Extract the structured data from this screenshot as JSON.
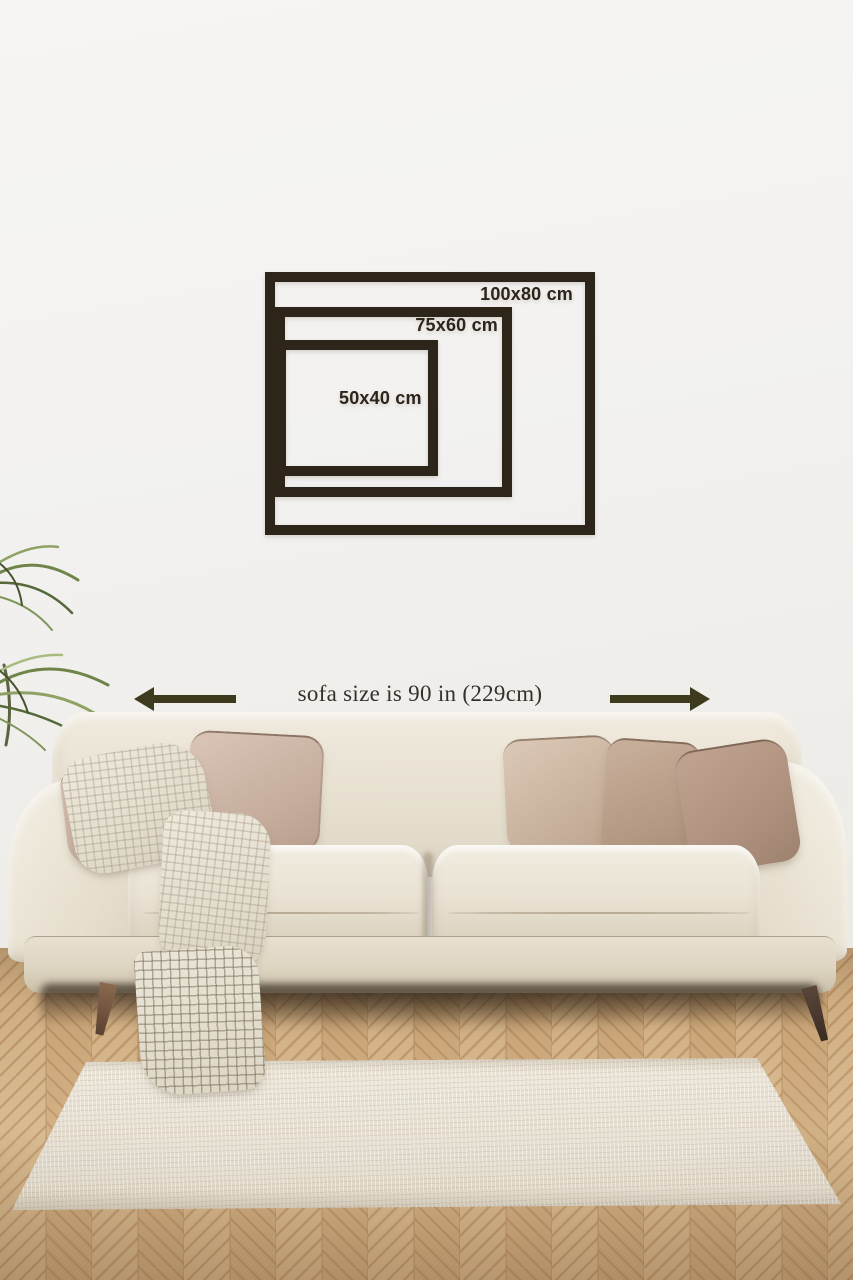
{
  "size_guide": {
    "frame_color": "#2d241a",
    "sizes": [
      {
        "label": "100x80 cm",
        "width_cm": 100,
        "height_cm": 80
      },
      {
        "label": "75x60 cm",
        "width_cm": 75,
        "height_cm": 60
      },
      {
        "label": "50x40 cm",
        "width_cm": 50,
        "height_cm": 40
      }
    ]
  },
  "sofa_annotation": {
    "text": "sofa size is 90 in (229cm)",
    "sofa_size_in": 90,
    "sofa_size_cm": 229,
    "arrow_color": "#3d3a1d",
    "text_color": "#35312a",
    "left_icon": "arrow-left",
    "right_icon": "arrow-right"
  },
  "scene": {
    "wall_color": "#f3f2f0",
    "sofa_color": "#ebe5d6",
    "floor_color": "#d4b183",
    "rug_color": "#e8e2d4",
    "pillow_colors": [
      "#cab3a4",
      "#cdb7a9",
      "#d0bcaa",
      "#b69d8c",
      "#b0937f"
    ],
    "plant_color": "#7d9355"
  }
}
